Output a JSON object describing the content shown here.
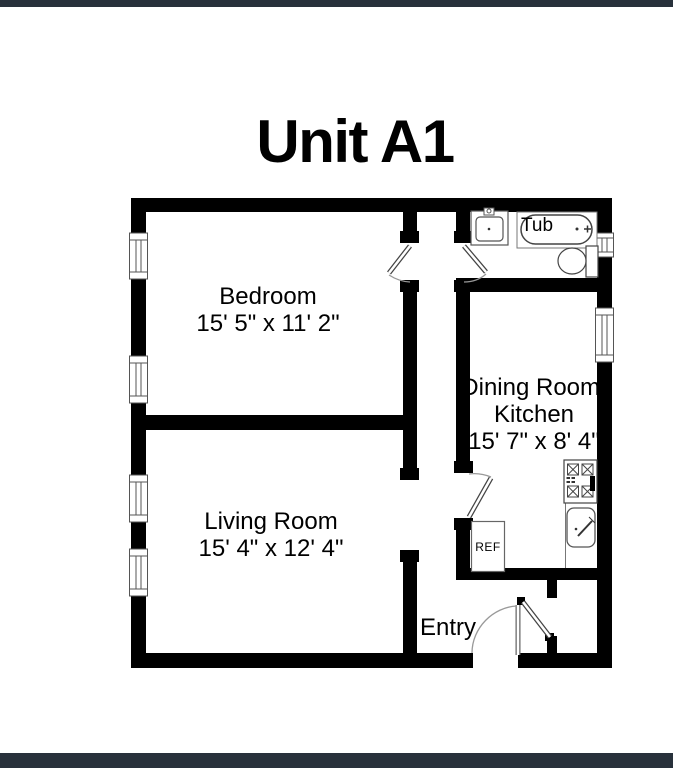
{
  "page": {
    "title": "Unit A1",
    "background_color": "#ffffff",
    "frame_bar_color": "#28313b",
    "wall_color": "#000000"
  },
  "rooms": {
    "bedroom": {
      "label": "Bedroom",
      "dimensions": "15' 5\" x 11' 2\""
    },
    "living_room": {
      "label": "Living Room",
      "dimensions": "15' 4\" x 12' 4\""
    },
    "dining_kitchen": {
      "label_line1": "Dining Room/",
      "label_line2": "Kitchen",
      "dimensions": "15' 7\" x 8' 4\""
    },
    "entry": {
      "label": "Entry"
    }
  },
  "fixtures": {
    "tub_label": "Tub",
    "refrigerator_label": "REF"
  }
}
